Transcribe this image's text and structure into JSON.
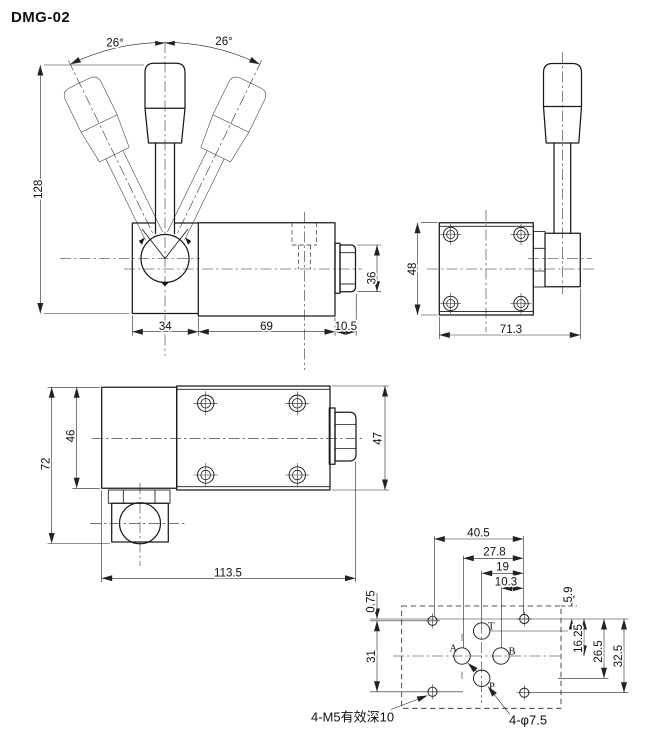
{
  "title": "DMG-02",
  "front_view": {
    "angle_left": "26°",
    "angle_right": "26°",
    "dim_height": "128",
    "dim_block_width": "34",
    "dim_body_width": "69",
    "dim_cap_width": "10.5",
    "dim_cap_height": "36"
  },
  "end_view": {
    "dim_height": "48",
    "dim_width": "71.3"
  },
  "top_view": {
    "dim_overall_height": "72",
    "dim_block_height": "46",
    "dim_overall_length": "113.5",
    "dim_body_height": "47"
  },
  "port_view": {
    "dim_hole_span_x": "40.5",
    "dim_a_to_hole": "27.8",
    "dim_center_to_hole": "19",
    "dim_b_to_hole": "10.3",
    "dim_edge_to_hole": "5.9",
    "dim_hole_to_ab": "16.25",
    "dim_hole_to_p": "26.5",
    "dim_hole_span_y_right": "32.5",
    "dim_hole_offset": "0.75",
    "dim_hole_span_y_left": "31",
    "port_t": "T",
    "port_a": "A",
    "port_b": "B",
    "port_p": "P",
    "note_threads": "4-M5有效深10",
    "note_ports": "4-φ7.5"
  }
}
